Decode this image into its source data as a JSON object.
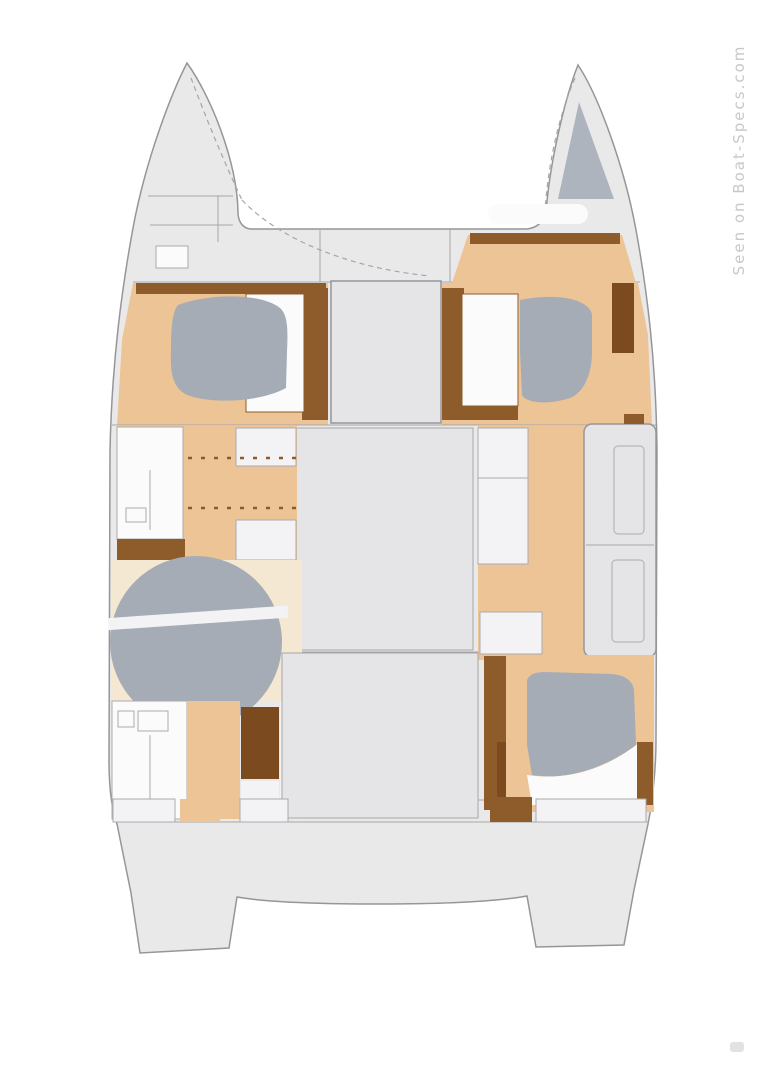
{
  "watermark": {
    "text": "Seen on Boat-Specs.com"
  },
  "colors": {
    "background": "#ffffff",
    "hull": "#e9e9ea",
    "hull_outline": "#96969a",
    "deck_line": "#a6a6a8",
    "salon": "#e5e5e7",
    "floor": "#ecc496",
    "wood": "#8e5c2b",
    "wood_dark": "#7b4a1e",
    "bed": "#a6acb5",
    "bed_dark": "#aeb4bd",
    "white": "#fbfbfc",
    "furniture": "#f3f3f5",
    "furniture_outline": "#ababad",
    "pale_floor": "#f5e8d3",
    "watermark": "#c8c8c8",
    "smudge": "#e2e2e4"
  }
}
